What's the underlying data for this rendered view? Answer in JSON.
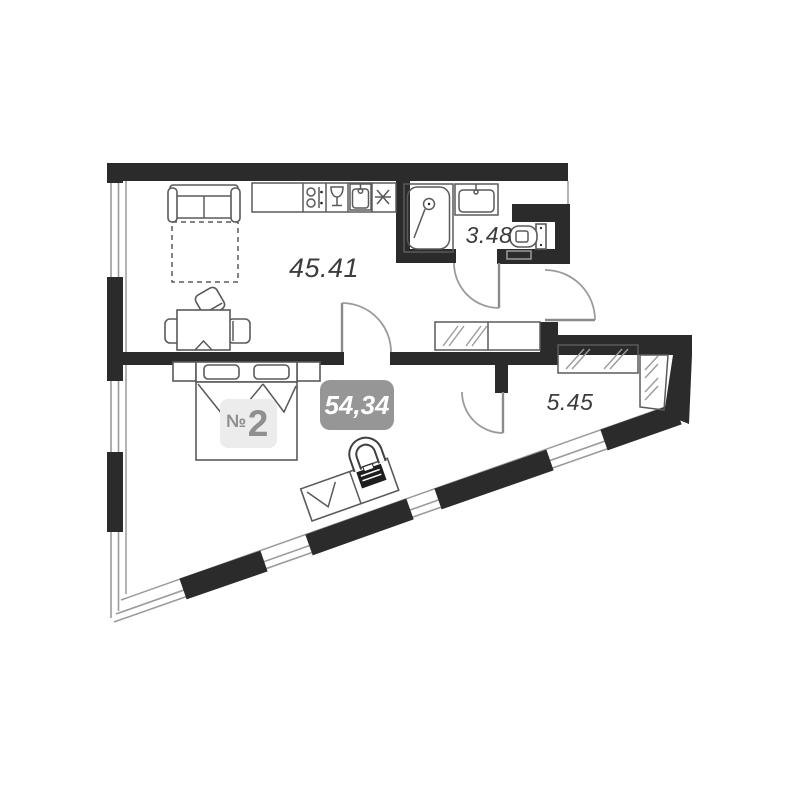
{
  "plan_title": "apartment-floor-plan",
  "colors": {
    "wall": "#2b2b2b",
    "line": "#9b9b9b",
    "furniture": "#5a5a5a",
    "label": "#3c3c3c",
    "total_badge_bg": "#969696",
    "total_badge_text": "#ffffff",
    "number_badge_bg": "#ececec",
    "number_badge_text": "#8f8f8f"
  },
  "rooms": {
    "living_kitchen": {
      "area": "45.41"
    },
    "bathroom": {
      "area": "3.48"
    },
    "dressing": {
      "area": "5.45"
    }
  },
  "badges": {
    "apartment_number_prefix": "№",
    "apartment_number_value": "2",
    "total_area": "54,34"
  }
}
